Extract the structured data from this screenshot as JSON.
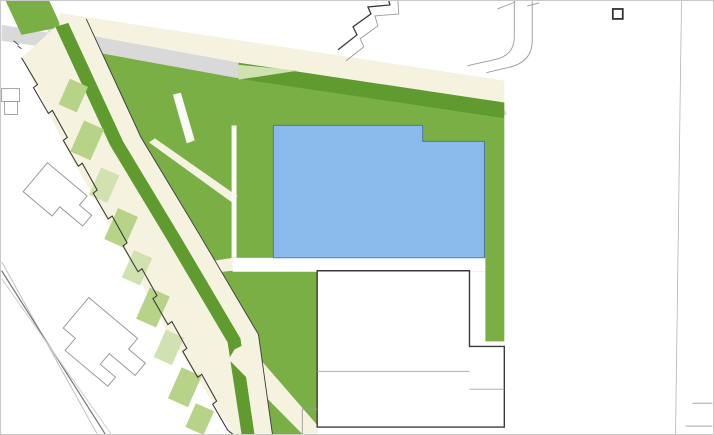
{
  "meta": {
    "type": "landscape site plan",
    "view": "top-down plan drawing"
  },
  "palette": {
    "lawn": "#79AF45",
    "verge": "#5F9B2F",
    "patchLight": "#B7D388",
    "patchLighter": "#CFE2AF",
    "cream": "#F6F2E0",
    "creamBright": "#FBFAF4",
    "road": "#D9D9D9",
    "white": "#FFFFFF",
    "blue": "#8ABAEB",
    "blueLine": "#4A77AC",
    "mint": "#6FCBA6",
    "mintLine": "#35896A",
    "treeA": "#74AB35",
    "treeB": "#7FB542",
    "treeC": "#689E2B",
    "treeLight": "#9DC45F",
    "treeStroke": "#55842A",
    "treeDot": "#3C641C",
    "shadow": "#9A9A9A",
    "outlineDark": "#3A3A3A",
    "outlineGray": "#9B9B9B",
    "gridLine": "#8F8F8F",
    "benchDark": "#4A5561",
    "doorGray": "#8F8F8F",
    "pathLine": "#A5A5A5"
  },
  "trees": {
    "boulevard_top": [
      [
        92,
        30,
        10
      ],
      [
        117,
        34,
        12
      ],
      [
        143,
        38,
        10
      ],
      [
        168,
        42,
        11
      ],
      [
        194,
        46,
        10
      ],
      [
        219,
        51,
        12
      ],
      [
        244,
        55,
        10
      ],
      [
        270,
        59,
        11
      ],
      [
        295,
        63,
        10
      ],
      [
        321,
        67,
        12
      ],
      [
        346,
        71,
        10
      ],
      [
        372,
        75,
        11
      ],
      [
        397,
        79,
        10
      ],
      [
        422,
        84,
        12
      ],
      [
        448,
        88,
        10
      ],
      [
        473,
        92,
        11
      ],
      [
        498,
        96,
        10
      ]
    ],
    "boulevard_lower": [
      [
        248,
        82,
        10
      ],
      [
        268,
        85,
        9
      ],
      [
        288,
        89,
        10
      ],
      [
        308,
        92,
        9
      ],
      [
        328,
        96,
        10
      ],
      [
        349,
        99,
        9
      ],
      [
        369,
        103,
        10
      ],
      [
        389,
        106,
        9
      ],
      [
        409,
        110,
        10
      ],
      [
        429,
        113,
        9
      ],
      [
        449,
        117,
        10
      ],
      [
        469,
        120,
        9
      ]
    ],
    "street_row": [
      [
        137,
        120,
        8
      ],
      [
        149,
        150,
        9
      ],
      [
        160,
        180,
        8
      ],
      [
        172,
        210,
        9
      ],
      [
        184,
        240,
        8
      ],
      [
        197,
        270,
        9
      ],
      [
        211,
        300,
        8
      ],
      [
        225,
        330,
        9
      ],
      [
        239,
        358,
        8
      ],
      [
        253,
        386,
        9
      ],
      [
        267,
        412,
        8
      ],
      [
        283,
        431,
        7
      ]
    ],
    "park_strip": [
      [
        42,
        45,
        13
      ],
      [
        63,
        76,
        15
      ],
      [
        52,
        100,
        10
      ],
      [
        83,
        113,
        14
      ],
      [
        70,
        140,
        9
      ],
      [
        100,
        148,
        13
      ],
      [
        88,
        175,
        9
      ],
      [
        115,
        185,
        14
      ],
      [
        105,
        215,
        9
      ],
      [
        130,
        222,
        13
      ],
      [
        118,
        255,
        9
      ],
      [
        145,
        260,
        14
      ],
      [
        133,
        295,
        9
      ],
      [
        160,
        300,
        13
      ],
      [
        148,
        333,
        9
      ],
      [
        175,
        338,
        14
      ],
      [
        163,
        370,
        9
      ],
      [
        190,
        375,
        13
      ],
      [
        178,
        408,
        9
      ],
      [
        205,
        412,
        13
      ],
      [
        220,
        432,
        9
      ]
    ],
    "lawn": [
      [
        256,
        98,
        17
      ],
      [
        197,
        99,
        15
      ],
      [
        213,
        140,
        13
      ],
      [
        232,
        178,
        11
      ],
      [
        210,
        216,
        12
      ],
      [
        234,
        252,
        11
      ],
      [
        252,
        300,
        12
      ],
      [
        268,
        331,
        11
      ],
      [
        288,
        384,
        12
      ],
      [
        302,
        416,
        11
      ],
      [
        312,
        424,
        7
      ]
    ],
    "right_strip": [
      [
        496,
        163,
        14
      ],
      [
        498,
        219,
        13
      ],
      [
        493,
        282,
        13
      ],
      [
        494,
        329,
        12
      ]
    ],
    "top_left": [
      [
        32,
        7,
        9
      ],
      [
        12,
        22,
        8
      ],
      [
        47,
        22,
        9
      ]
    ]
  },
  "furniture": {
    "items": [
      {
        "x": 98,
        "y": 63,
        "rot": 24,
        "name": "bench-icon"
      },
      {
        "x": 104,
        "y": 76,
        "rot": 24,
        "name": "waste-bin-icon"
      },
      {
        "x": 109,
        "y": 88,
        "rot": 24,
        "name": "picnic-table-icon"
      },
      {
        "x": 115,
        "y": 100,
        "rot": 24,
        "name": "bench-icon"
      },
      {
        "x": 121,
        "y": 113,
        "rot": 24,
        "name": "bike-rack-icon"
      },
      {
        "x": 127,
        "y": 125,
        "rot": 24,
        "name": "bench-icon"
      },
      {
        "x": 133,
        "y": 137,
        "rot": 24,
        "name": "picnic-table-icon"
      },
      {
        "x": 150,
        "y": 165,
        "rot": 24,
        "name": "waste-bin-icon"
      },
      {
        "x": 166,
        "y": 192,
        "rot": 24,
        "name": "bench-icon"
      },
      {
        "x": 182,
        "y": 218,
        "rot": 24,
        "name": "bike-rack-icon"
      },
      {
        "x": 197,
        "y": 244,
        "rot": 24,
        "name": "picnic-table-icon"
      },
      {
        "x": 213,
        "y": 270,
        "rot": 24,
        "name": "bench-icon"
      },
      {
        "x": 230,
        "y": 300,
        "rot": 24,
        "name": "waste-bin-icon"
      },
      {
        "x": 248,
        "y": 330,
        "rot": 24,
        "name": "bench-icon"
      },
      {
        "x": 254,
        "y": 356,
        "rot": 24,
        "name": "picnic-table-icon"
      },
      {
        "x": 258,
        "y": 384,
        "rot": 24,
        "name": "bike-rack-icon"
      },
      {
        "x": 262,
        "y": 410,
        "rot": 24,
        "name": "bench-icon"
      },
      {
        "x": 283,
        "y": 389,
        "rot": 42,
        "name": "picnic-table-icon"
      },
      {
        "x": 291,
        "y": 404,
        "rot": 42,
        "name": "bench-icon"
      },
      {
        "x": 299,
        "y": 419,
        "rot": 42,
        "name": "waste-bin-icon"
      }
    ]
  },
  "park_patches": [
    [
      72,
      95,
      20,
      28,
      0
    ],
    [
      86,
      140,
      22,
      34,
      0
    ],
    [
      103,
      185,
      20,
      30,
      1
    ],
    [
      120,
      228,
      22,
      34,
      0
    ],
    [
      136,
      268,
      20,
      30,
      1
    ],
    [
      152,
      308,
      22,
      34,
      0
    ],
    [
      168,
      348,
      20,
      30,
      1
    ],
    [
      184,
      388,
      22,
      34,
      0
    ],
    [
      199,
      420,
      20,
      26,
      0
    ]
  ],
  "courts": {
    "dividers": [
      297,
      361,
      423
    ],
    "tennis_courts": [
      [
        309,
        150,
        40,
        84
      ],
      [
        372,
        150,
        40,
        84
      ],
      [
        434,
        159,
        40,
        82
      ]
    ],
    "walkway_benches": [
      [
        284,
        152
      ],
      [
        284,
        196
      ],
      [
        284,
        239
      ]
    ],
    "mint_upper": {
      "block": [
        237,
        125,
        36,
        132
      ],
      "courts": [
        [
          240,
          129,
          30,
          56
        ],
        [
          240,
          197,
          30,
          56
        ]
      ],
      "mid_lines": [
        187,
        190
      ]
    },
    "mint_lower": {
      "rect": [
        283,
        271,
        32,
        64
      ]
    },
    "mini_court": {
      "rect": [
        147,
        86,
        26,
        48
      ],
      "rot": 24,
      "cx": 160,
      "cy": 110
    }
  },
  "doors": [
    [
      288,
      263
    ],
    [
      352,
      264
    ],
    [
      415,
      265
    ],
    [
      478,
      266
    ]
  ],
  "east_blocks": [
    {
      "o": [
        559,
        58,
        102,
        110
      ],
      "i": [
        568,
        66,
        84,
        94
      ],
      "vx": [
        600,
        627
      ],
      "hy": [
        90,
        113,
        136
      ]
    },
    {
      "o": [
        558,
        197,
        99,
        231
      ],
      "i": [
        566,
        205,
        83,
        215
      ],
      "vx": [
        599,
        621
      ],
      "hy": [
        225,
        244,
        264,
        283,
        303,
        322,
        342,
        361,
        381,
        400
      ]
    },
    {
      "o": [
        687,
        58,
        60,
        110
      ],
      "i": [
        695,
        66,
        52,
        94
      ],
      "vx": [],
      "hy": [
        90,
        113,
        136
      ]
    },
    {
      "o": [
        687,
        197,
        60,
        206
      ],
      "i": [
        695,
        205,
        52,
        190
      ],
      "vx": [],
      "hy": [
        225,
        244,
        264,
        283,
        303,
        322,
        342,
        361,
        381
      ]
    }
  ]
}
